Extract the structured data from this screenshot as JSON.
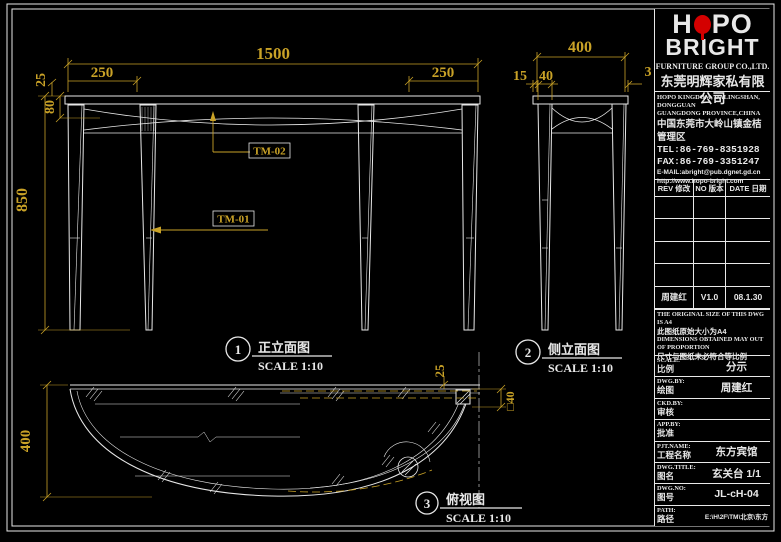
{
  "page": {
    "background": "#000000",
    "line_color": "#e8e8e8",
    "dim_color": "#c9a227",
    "accent_red": "#d40000"
  },
  "views": {
    "front": {
      "callout_no": "1",
      "title": "正立面图",
      "scale_label": "SCALE 1:10",
      "dims": {
        "width": "1500",
        "left_overhang": "250",
        "right_overhang": "250",
        "top_thickness": "25",
        "apron_height": "80",
        "height": "850"
      },
      "part_labels": {
        "tm01": "TM-01",
        "tm02": "TM-02"
      }
    },
    "side": {
      "callout_no": "2",
      "title": "侧立面图",
      "scale_label": "SCALE 1:10",
      "dims": {
        "depth": "400",
        "edge_offset": "15",
        "leg_width": "40",
        "back_gap": "3"
      }
    },
    "plan": {
      "callout_no": "3",
      "title": "俯视图",
      "scale_label": "SCALE 1:10",
      "dims": {
        "depth": "400",
        "edge": "25",
        "leg_square": "□40"
      }
    }
  },
  "title_block": {
    "logo": {
      "part1": "H",
      "part2": "PO",
      "line2": "BRIGHT"
    },
    "company_en": "FURNITURE GROUP CO.,LTD.",
    "company_cn": "东莞明辉家私有限公司",
    "address_en1": "HOPO KINGDOM, DALINGSHAN, DONGGUAN",
    "address_en2": "GUANGDONG PROVINCE,CHINA",
    "address_cn": "中国东莞市大岭山镇金桔管理区",
    "tel": "TEL:86-769-8351928",
    "fax": "FAX:86-769-3351247",
    "email": "E-MAIL:abright@pub.dgnet.gd.cn",
    "website": "http://www.hopo-bright.com",
    "rev_table": {
      "headers": [
        "REV 修改",
        "NO 版本",
        "DATE 日期"
      ],
      "rows": [
        [
          "",
          "",
          ""
        ],
        [
          "",
          "",
          ""
        ],
        [
          "",
          "",
          ""
        ],
        [
          "",
          "",
          ""
        ],
        [
          "周建红",
          "V1.0",
          "08.1.30"
        ]
      ]
    },
    "notes": [
      "THE ORIGINAL SIZE OF THIS DWG IS A4",
      "此图纸原始大小为A4",
      "DIMENSIONS OBTAINED MAY OUT",
      "OF PROPORTION",
      "尺寸与图纸未必符合等比例"
    ],
    "fields": [
      {
        "en": "SCALE:",
        "cn": "比例",
        "value": "分示"
      },
      {
        "en": "DWG.BY:",
        "cn": "绘图",
        "value": "周建红"
      },
      {
        "en": "CKD.BY:",
        "cn": "审核",
        "value": ""
      },
      {
        "en": "APP.BY:",
        "cn": "批准",
        "value": ""
      },
      {
        "en": "PJT.NAME:",
        "cn": "工程名称",
        "value": "东方宾馆"
      },
      {
        "en": "DWG.TITLE:",
        "cn": "图名",
        "value": "玄关台 1/1"
      },
      {
        "en": "DWG.NO:",
        "cn": "图号",
        "value": "JL-cH-04"
      },
      {
        "en": "PATH:",
        "cn": "路径",
        "value": "E:\\H\\2F\\TM\\北京\\东方"
      }
    ]
  }
}
